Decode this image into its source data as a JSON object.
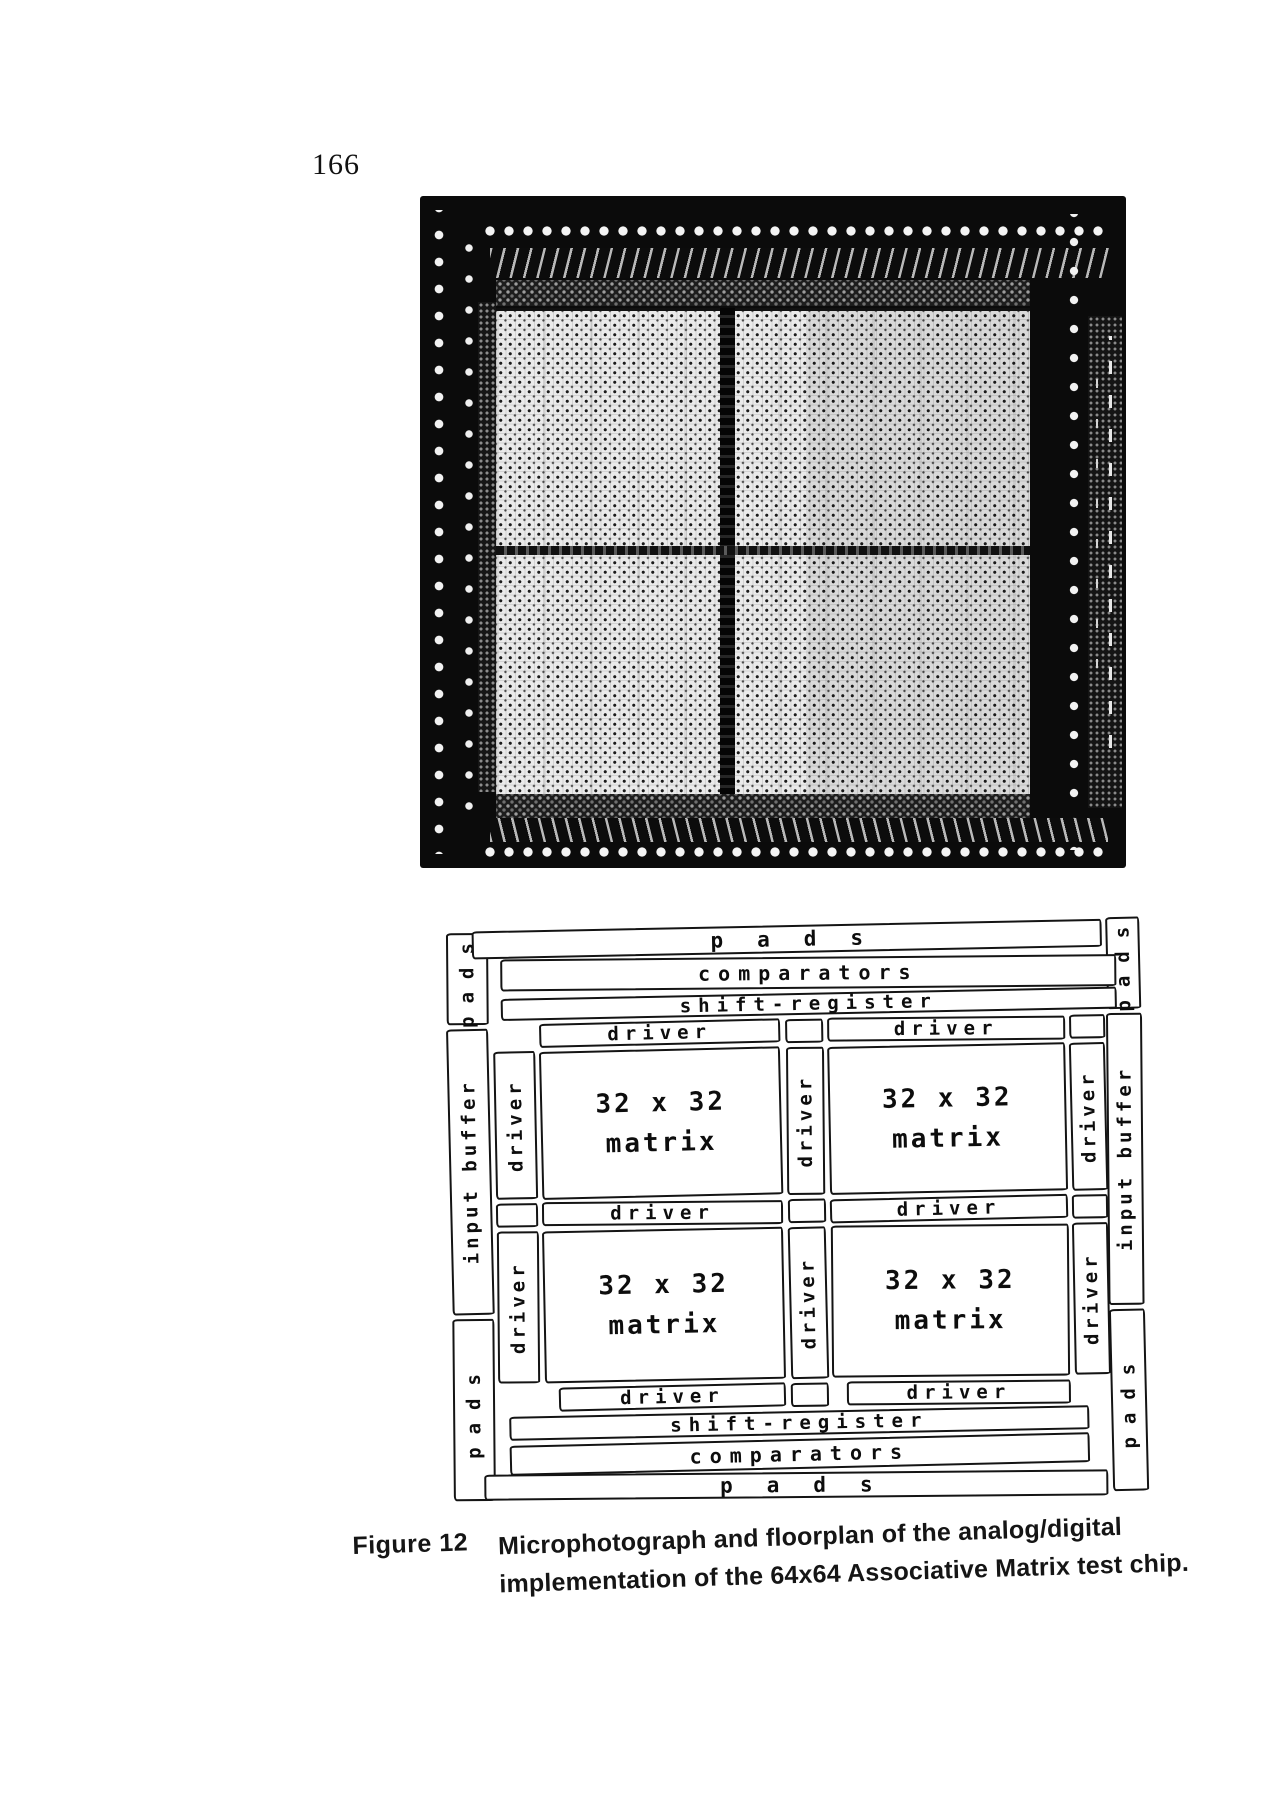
{
  "page": {
    "number": "166"
  },
  "figure": {
    "label": "Figure 12",
    "caption_line1": "Microphotograph and floorplan of the analog/digital",
    "caption_line2": "implementation of the 64x64 Associative Matrix test chip."
  },
  "floorplan": {
    "labels": {
      "pads": "pads",
      "comparators": "comparators",
      "shift_register": "shift-register",
      "driver": "driver",
      "input_buffer": "input buffer",
      "matrix_line1": "32 x 32",
      "matrix_line2": "matrix"
    }
  }
}
